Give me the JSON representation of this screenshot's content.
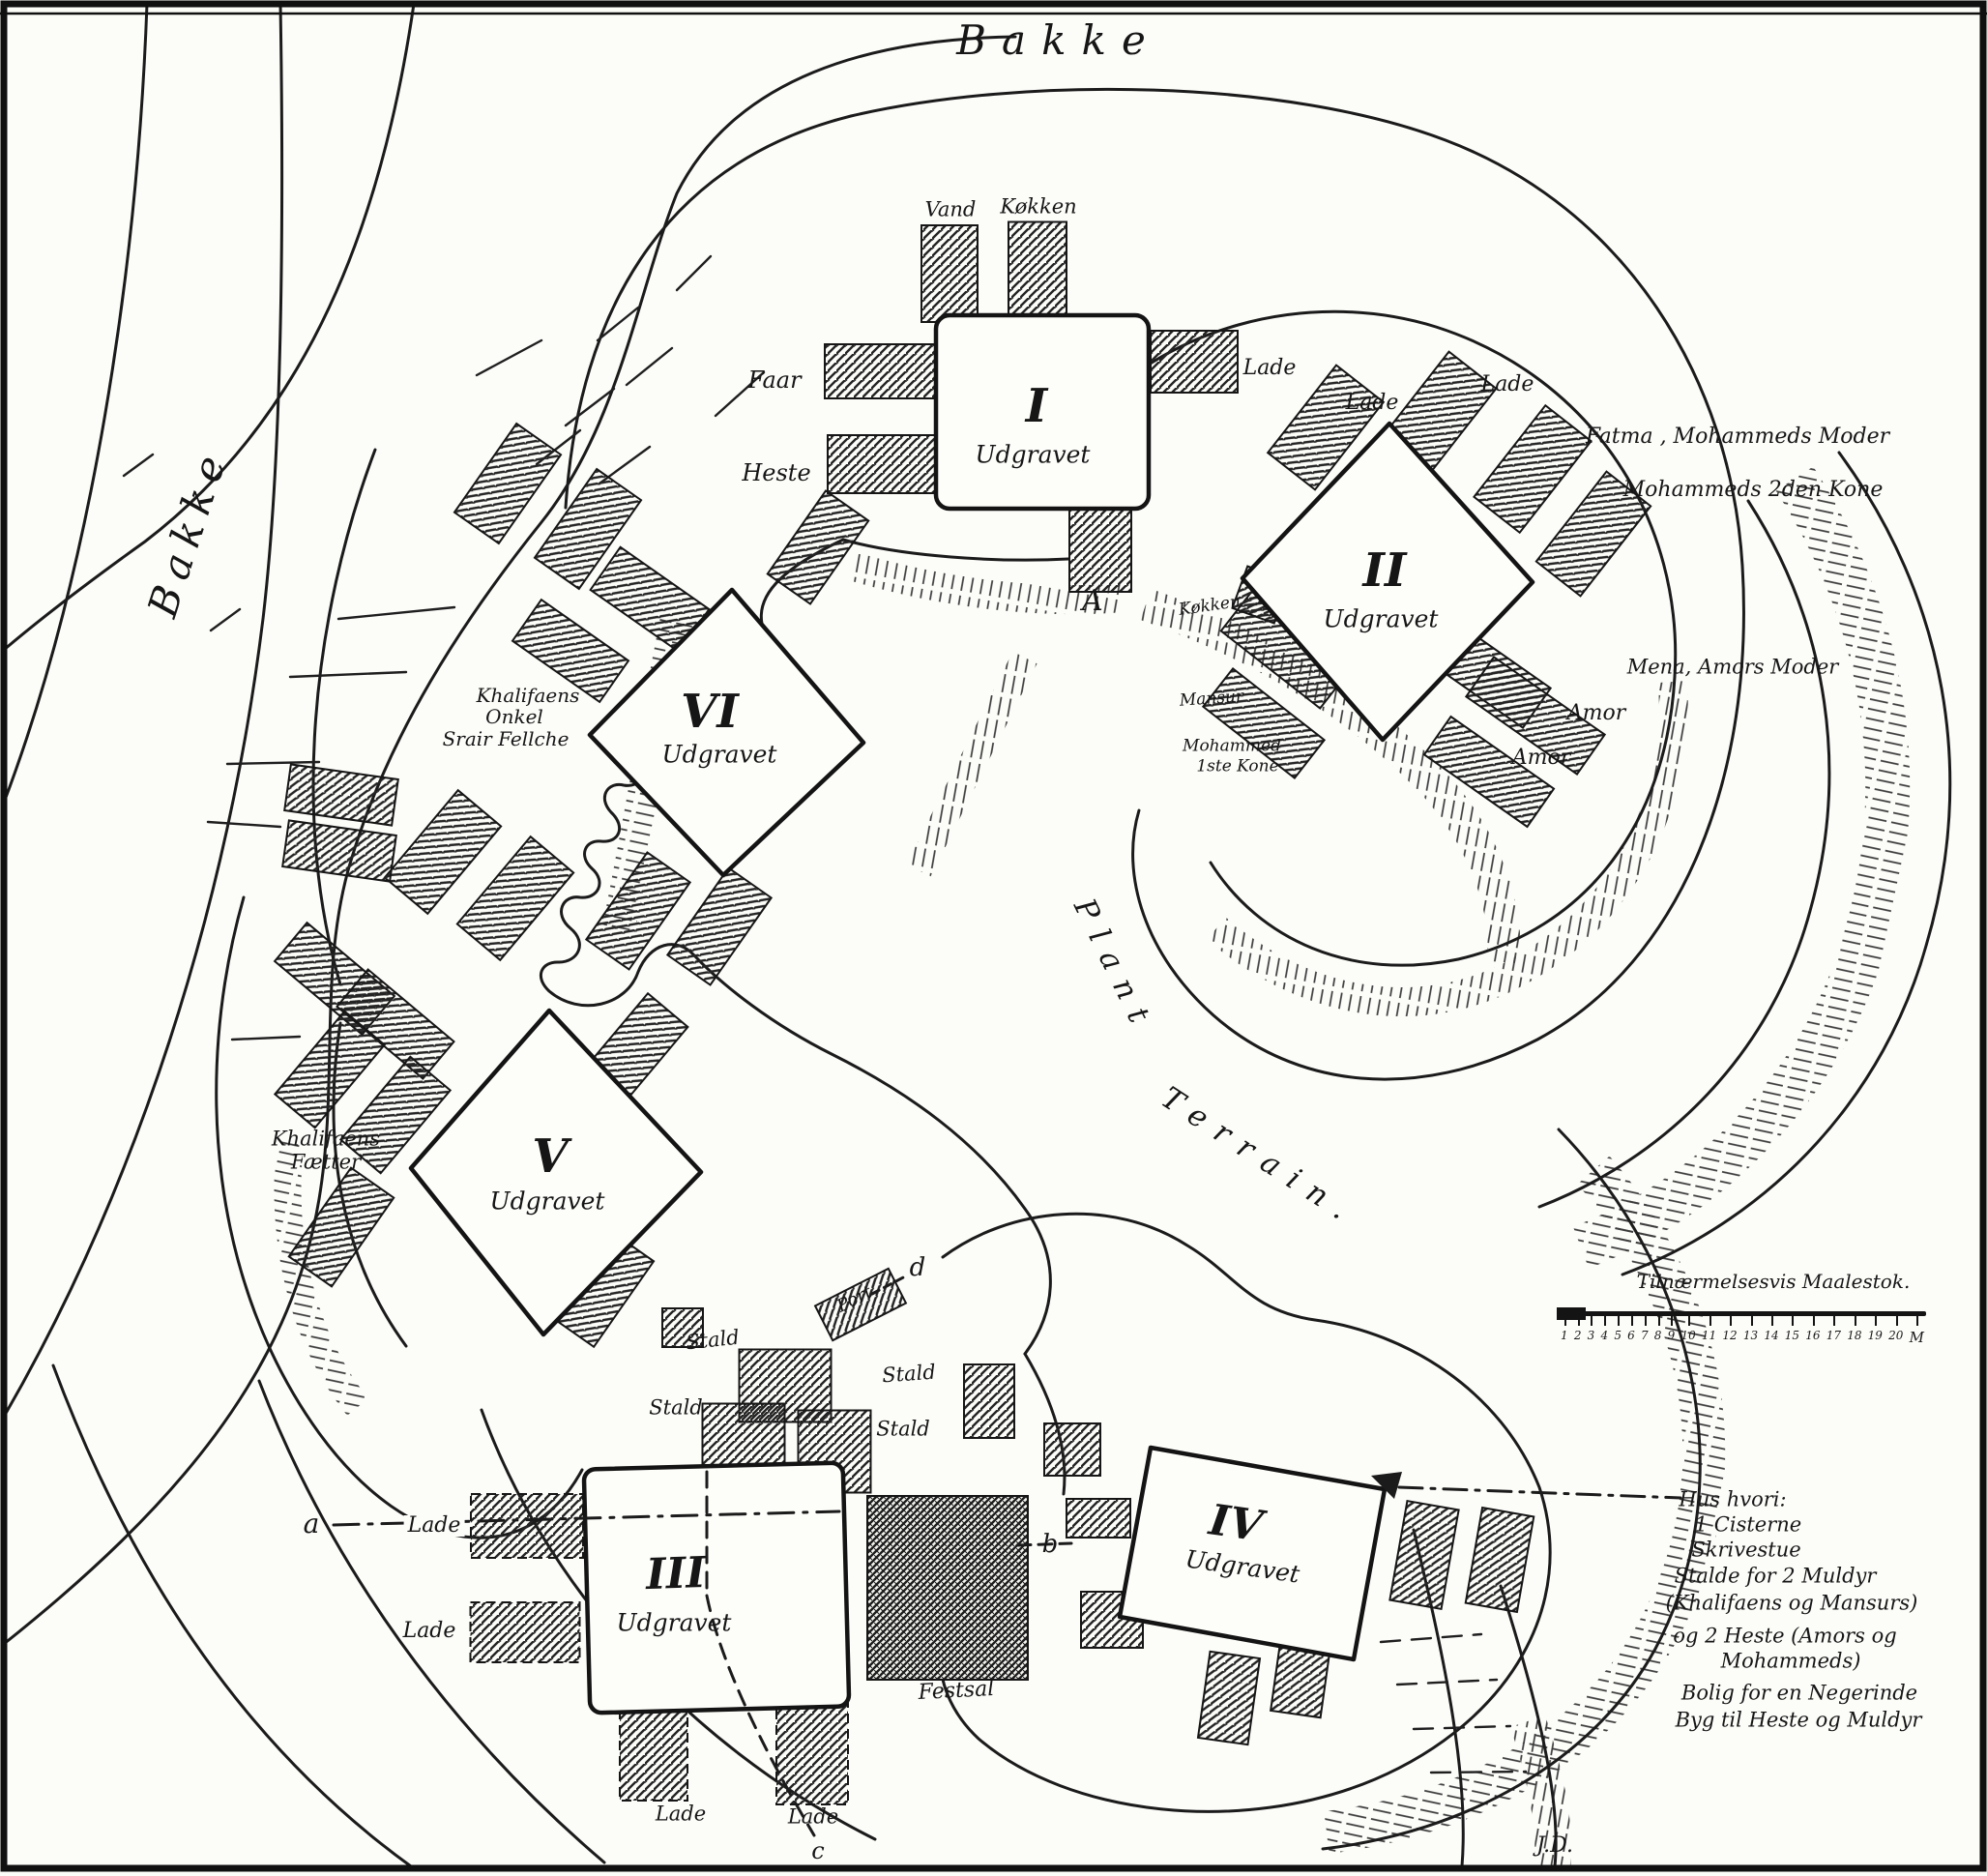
{
  "titles": {
    "bakke_top": "Bakke",
    "bakke_left": "Bakke",
    "plant": "Plant",
    "terrain": "Terrain.",
    "signature": "J.D."
  },
  "buildings": [
    {
      "numeral": "I",
      "status": "Udgravet"
    },
    {
      "numeral": "II",
      "status": "Udgravet"
    },
    {
      "numeral": "III",
      "status": "Udgravet"
    },
    {
      "numeral": "IV",
      "status": "Udgravet"
    },
    {
      "numeral": "V",
      "status": "Udgravet"
    },
    {
      "numeral": "VI",
      "status": "Udgravet"
    }
  ],
  "labels": [
    {
      "text": "Vand"
    },
    {
      "text": "Køkken"
    },
    {
      "text": "Faar"
    },
    {
      "text": "Heste"
    },
    {
      "text": "Lade"
    },
    {
      "text": "Lade"
    },
    {
      "text": "Lade"
    },
    {
      "text": "Fatma , Mohammeds Moder"
    },
    {
      "text": "Mohammeds 2den Kone"
    },
    {
      "text": "Køkken"
    },
    {
      "text": "Mansur"
    },
    {
      "text": "Mohammed"
    },
    {
      "text": "1ste Kone"
    },
    {
      "text": "Mena, Amors Moder"
    },
    {
      "text": "Amor"
    },
    {
      "text": "Amor"
    },
    {
      "text": "Khalifaens"
    },
    {
      "text": "Onkel"
    },
    {
      "text": "Srair Fellche"
    },
    {
      "text": "Khalifaens"
    },
    {
      "text": "Fætter"
    },
    {
      "text": "Stald"
    },
    {
      "text": "Stald"
    },
    {
      "text": "Stald"
    },
    {
      "text": "Stald"
    },
    {
      "text": "Port"
    },
    {
      "text": "Lade"
    },
    {
      "text": "Lade"
    },
    {
      "text": "Lade"
    },
    {
      "text": "Lade"
    },
    {
      "text": "Festsal"
    }
  ],
  "markers": {
    "A": "A",
    "a": "a",
    "b": "b",
    "c": "c",
    "d": "d"
  },
  "legend": {
    "lines": [
      "Hus hvori:",
      "1 Cisterne",
      "Skrivestue",
      "Stalde for 2 Muldyr",
      "(Khalifaens og Mansurs)",
      "og 2 Heste (Amors og",
      "Mohammeds)",
      "Bolig for en Negerinde",
      "Byg til Heste og Muldyr"
    ]
  },
  "scale": {
    "title": "Tilnærmelsesvis Maalestok.",
    "ticks": [
      "1",
      "2",
      "3",
      "4",
      "5",
      "6",
      "7",
      "8",
      "9",
      "10",
      "11",
      "12",
      "13",
      "14",
      "15",
      "16",
      "17",
      "18",
      "19",
      "20"
    ],
    "unit": "M"
  }
}
